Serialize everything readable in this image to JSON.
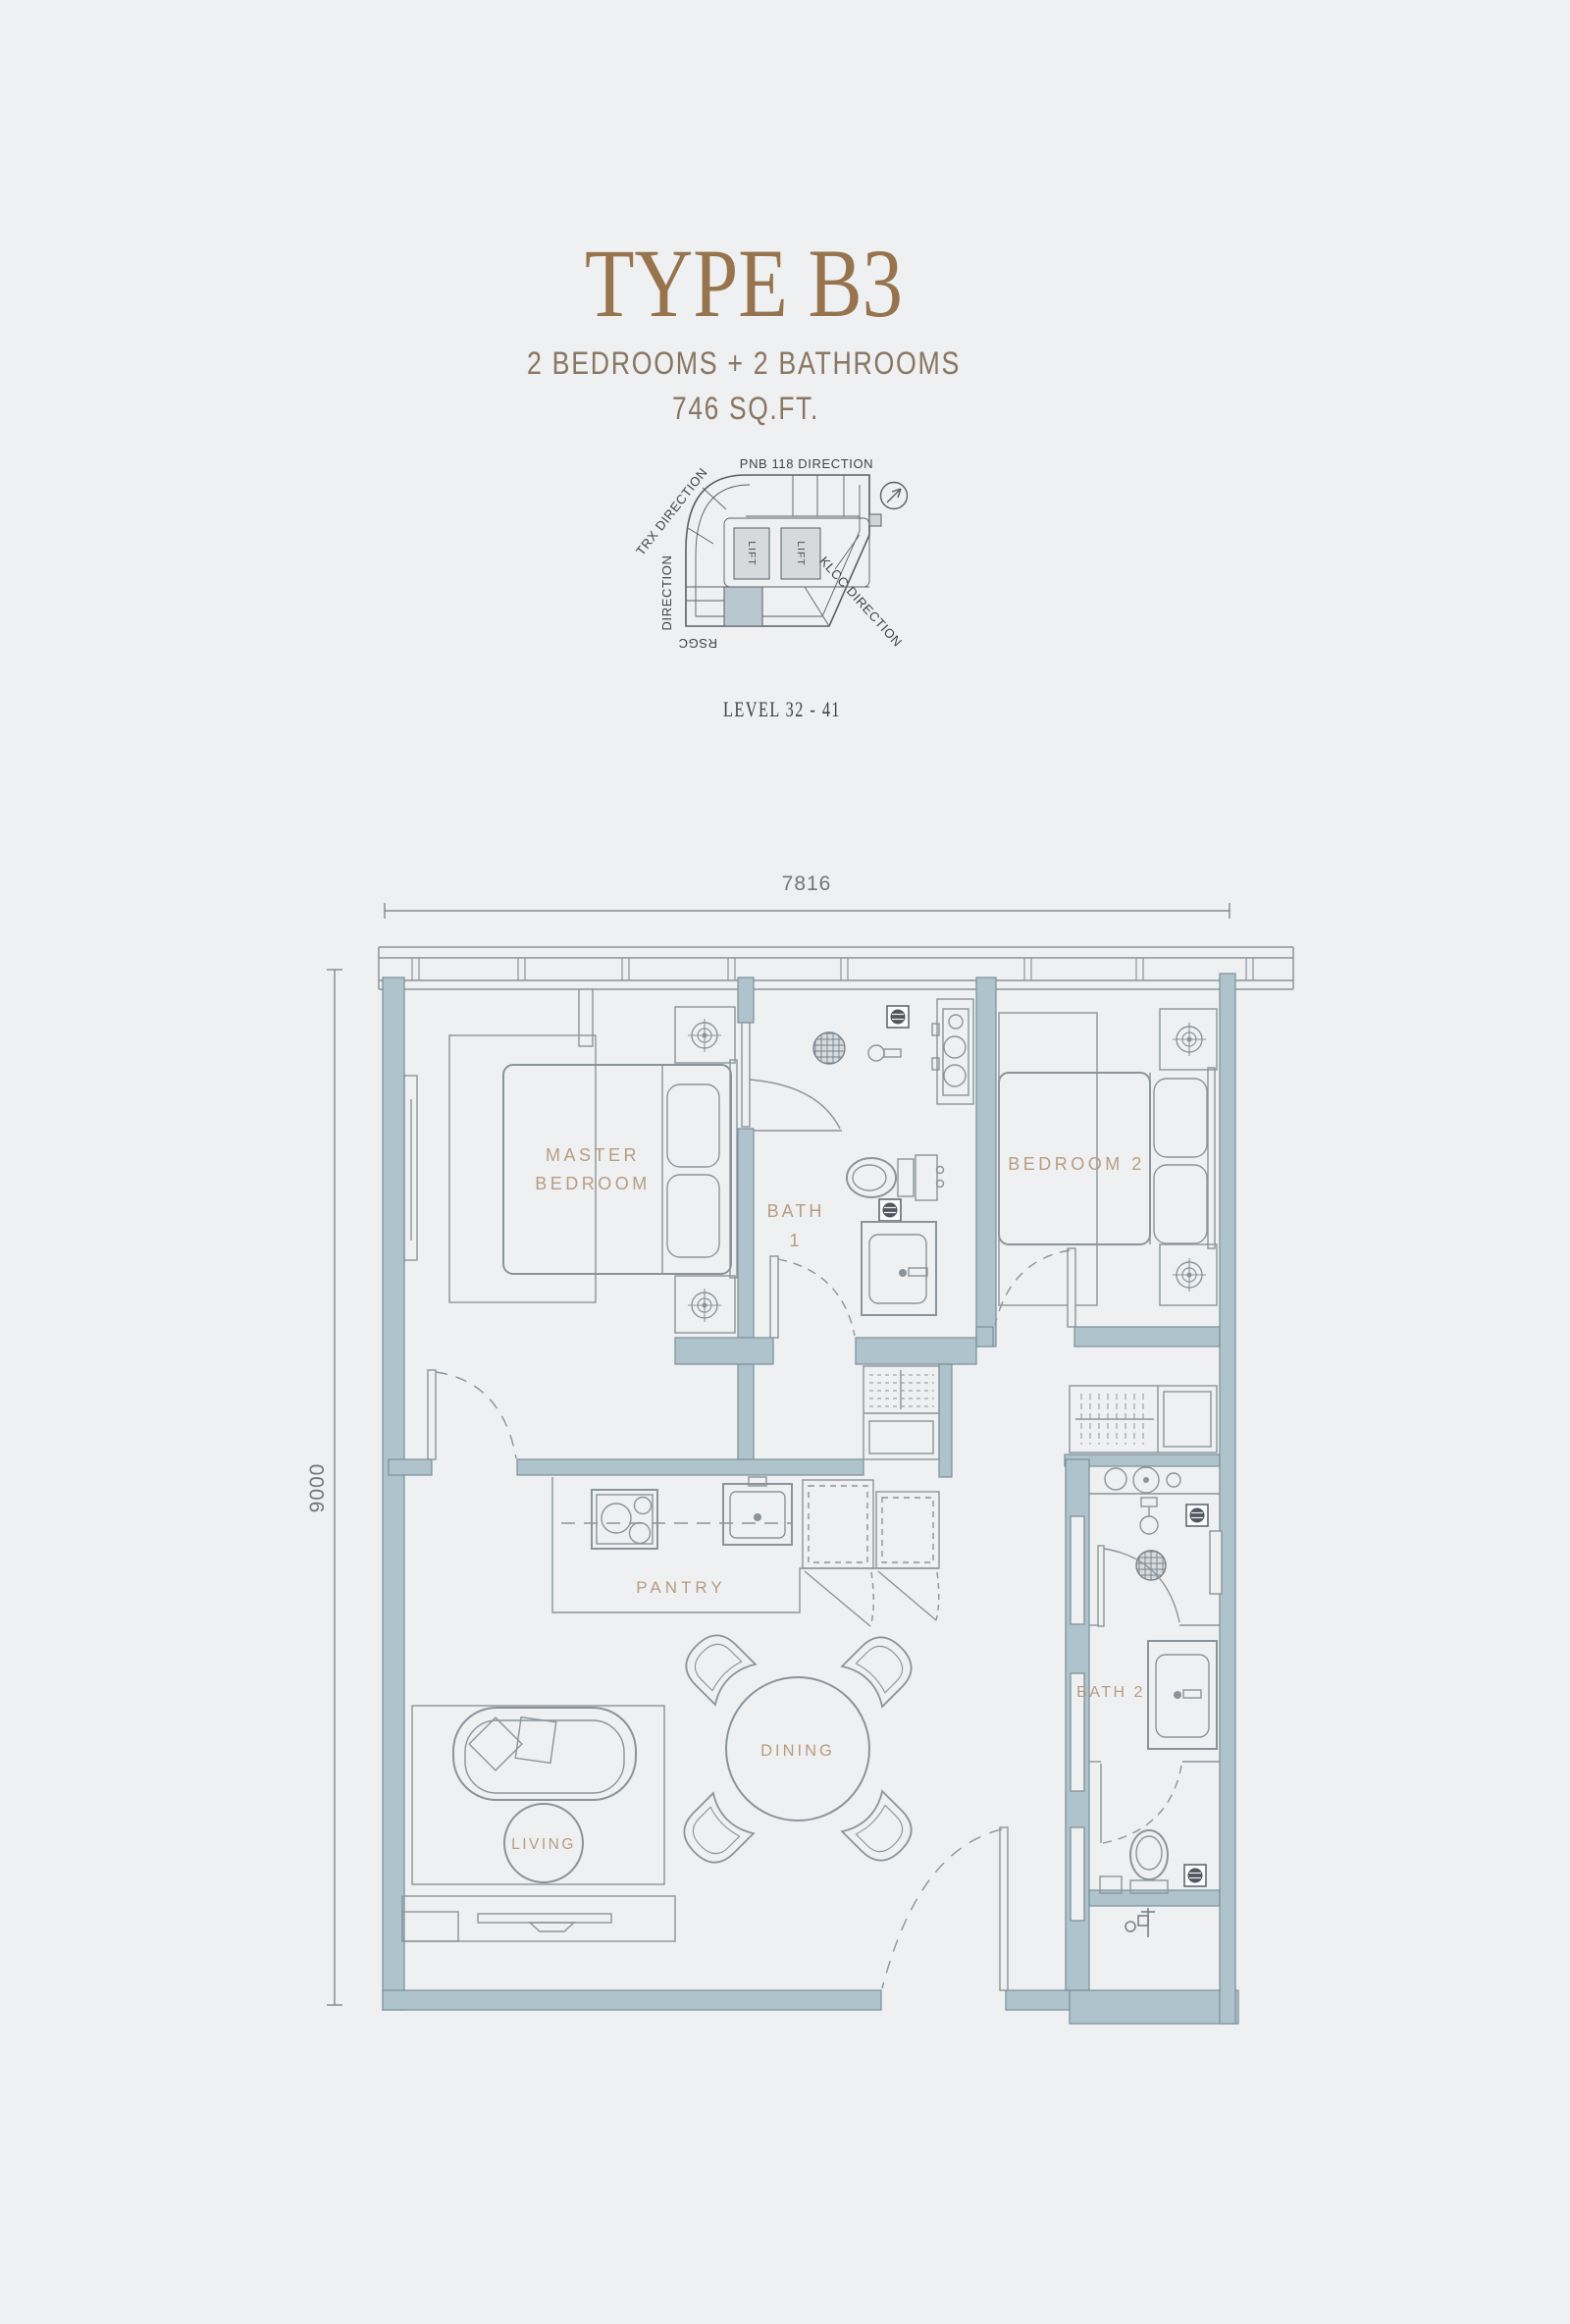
{
  "header": {
    "title": "TYPE B3",
    "subtitle": "2 BEDROOMS + 2 BATHROOMS",
    "area": "746 SQ.FT.",
    "level": "LEVEL 32 - 41"
  },
  "key_plan": {
    "top_label": "PNB 118 DIRECTION",
    "trx_label": "TRX DIRECTION",
    "direction_word": "DIRECTION",
    "rsgc_word": "RSGC",
    "klcc_label": "KLCC DIRECTION",
    "lifts": [
      "LIFT",
      "LIFT"
    ],
    "highlight_color": "#b9c8cf"
  },
  "floor_plan": {
    "dimensions": {
      "width": "7816",
      "height": "9000"
    },
    "rooms": {
      "master_bedroom": {
        "line1": "MASTER",
        "line2": "BEDROOM"
      },
      "bath1": {
        "line1": "BATH",
        "line2": "1"
      },
      "bedroom2": "BEDROOM 2",
      "pantry": "PANTRY",
      "bath2": "BATH 2",
      "dining": "DINING",
      "living": "LIVING"
    },
    "colors": {
      "background": "#eef0f1",
      "wall_fill": "#aec3cb",
      "wall_stroke": "#7b8f99",
      "furniture_line": "#8b949b",
      "room_label": "#b79d80",
      "title": "#97744e",
      "subtitle": "#897663",
      "key_text": "#3f444a",
      "dimension_text": "#70777d",
      "dark_fixture": "#50565c",
      "unit_highlight": "#b9c8cf"
    }
  }
}
